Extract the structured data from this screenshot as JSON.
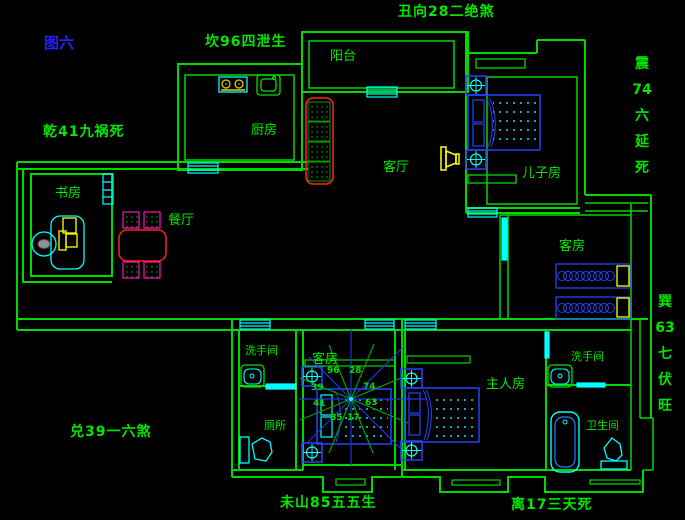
{
  "figure_label": "图六",
  "fengshui_labels": {
    "top_center": "丑向28二绝煞",
    "upper_left": "坎96四泄生",
    "west_upper": "乾41九祸死",
    "west_lower": "兑39一六煞",
    "bottom_center": "未山85五五生",
    "bottom_right": "离17三天死",
    "east_upper": [
      "震",
      "74",
      "六",
      "延",
      "死"
    ],
    "east_lower": [
      "巽",
      "63",
      "七",
      "伏",
      "旺"
    ]
  },
  "rooms": {
    "balcony": "阳台",
    "kitchen": "厨房",
    "study": "书房",
    "dining": "餐厅",
    "living": "客厅",
    "son_bedroom": "儿子房",
    "guest_bedroom_east": "客房",
    "guest_bedroom_center": "客房",
    "master_bedroom": "主人房",
    "washroom_west": "洗手间",
    "toilet_west": "厕所",
    "washroom_master": "洗手间",
    "bathroom_master": "卫生间"
  },
  "compass_numbers": [
    "96",
    "28",
    "74",
    "63",
    "17",
    "85",
    "41",
    "39"
  ],
  "colors": {
    "wall_green": "#00D800",
    "text_green": "#00E800",
    "cyan": "#00FFFF",
    "bed_blue": "#2244FF",
    "yellow": "#FFFF00",
    "red": "#FF2020",
    "magenta": "#FF10C0",
    "figure_blue": "#2222FF",
    "star_blue": "#2233DD",
    "star_green": "#00A000"
  }
}
